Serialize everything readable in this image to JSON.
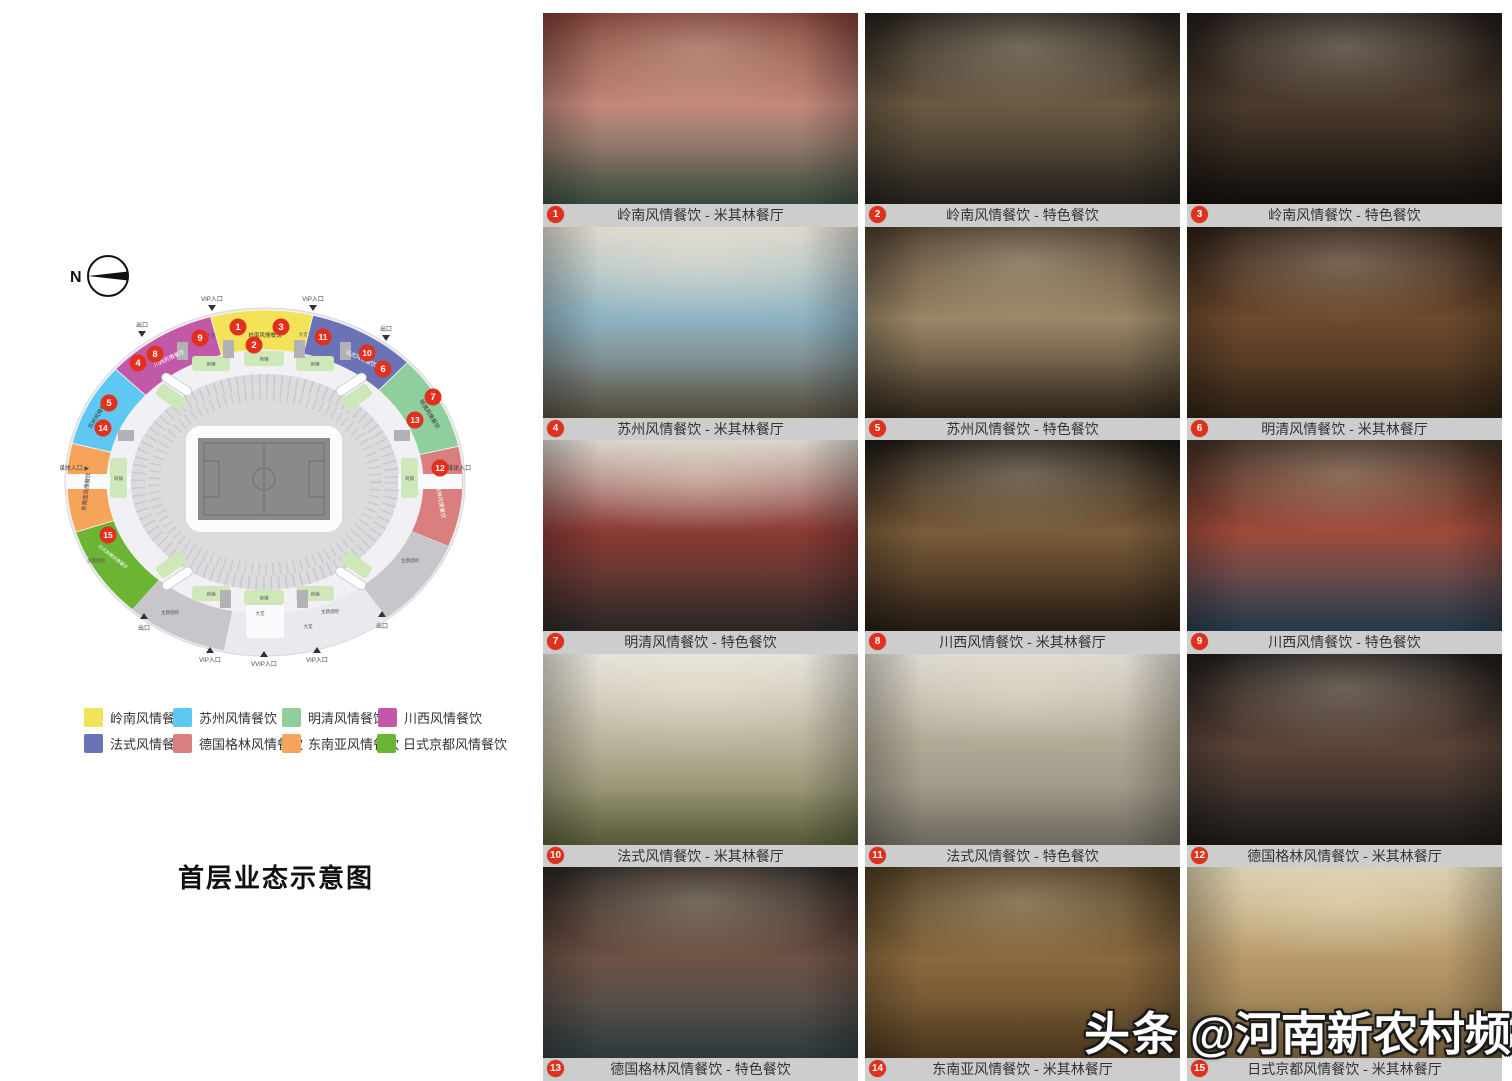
{
  "title": "首层业态示意图",
  "compass": {
    "north_label": "N"
  },
  "legend": {
    "items": [
      {
        "label": "岭南风情餐饮",
        "color": "#f2e359"
      },
      {
        "label": "苏州风情餐饮",
        "color": "#5ec8f2"
      },
      {
        "label": "明清风情餐饮",
        "color": "#8fce9d"
      },
      {
        "label": "川西风情餐饮",
        "color": "#c159a8"
      },
      {
        "label": "法式风情餐饮",
        "color": "#6a73b5"
      },
      {
        "label": "德国格林风情餐饮",
        "color": "#d97f7f"
      },
      {
        "label": "东南亚风情餐饮",
        "color": "#f6a45a"
      },
      {
        "label": "日式京都风情餐饮",
        "color": "#6cb434"
      }
    ]
  },
  "stadium": {
    "labels": {
      "vip_entrance": "VIP入口",
      "vvip_entrance": "VVIP入口",
      "exit": "出口",
      "media_entrance_left": "媒体入口 ▶",
      "media_entrance_right": "◀ 媒体入口",
      "lobby": "大堂",
      "theme_bar": "主题酒吧",
      "shop": "商铺"
    },
    "markers": [
      {
        "num": "1"
      },
      {
        "num": "2"
      },
      {
        "num": "3"
      },
      {
        "num": "4"
      },
      {
        "num": "5"
      },
      {
        "num": "6"
      },
      {
        "num": "7"
      },
      {
        "num": "8"
      },
      {
        "num": "9"
      },
      {
        "num": "10"
      },
      {
        "num": "11"
      },
      {
        "num": "12"
      },
      {
        "num": "13"
      },
      {
        "num": "14"
      },
      {
        "num": "15"
      }
    ]
  },
  "photos": [
    {
      "num": "1",
      "caption": "岭南风情餐饮 - 米其林餐厅",
      "palette": [
        "#7a3d33",
        "#c4897c",
        "#49604e"
      ]
    },
    {
      "num": "2",
      "caption": "岭南风情餐饮 - 特色餐饮",
      "palette": [
        "#241f1a",
        "#6b5a42",
        "#2e2a24"
      ]
    },
    {
      "num": "3",
      "caption": "岭南风情餐饮 - 特色餐饮",
      "palette": [
        "#221c18",
        "#4a3a2c",
        "#17130f"
      ]
    },
    {
      "num": "4",
      "caption": "苏州风情餐饮 - 米其林餐厅",
      "palette": [
        "#ddd8cc",
        "#8fb4c4",
        "#6a5f4c"
      ]
    },
    {
      "num": "5",
      "caption": "苏州风情餐饮 - 特色餐饮",
      "palette": [
        "#4a3a2a",
        "#9a8868",
        "#3a2e20"
      ]
    },
    {
      "num": "6",
      "caption": "明清风情餐饮 - 米其林餐厅",
      "palette": [
        "#2a1f16",
        "#6e4a2e",
        "#3a2a1a"
      ]
    },
    {
      "num": "7",
      "caption": "明清风情餐饮 - 特色餐饮",
      "palette": [
        "#d8d4cc",
        "#8a3a34",
        "#35322e"
      ]
    },
    {
      "num": "8",
      "caption": "川西风情餐饮 - 米其林餐厅",
      "palette": [
        "#1a1714",
        "#7a5c3a",
        "#2e2318"
      ]
    },
    {
      "num": "9",
      "caption": "川西风情餐饮 - 特色餐饮",
      "palette": [
        "#3a2e22",
        "#a04a3a",
        "#2e4a5e"
      ]
    },
    {
      "num": "10",
      "caption": "法式风情餐饮 - 米其林餐厅",
      "palette": [
        "#e5e2da",
        "#b8b29a",
        "#6e7248"
      ]
    },
    {
      "num": "11",
      "caption": "法式风情餐饮 - 特色餐饮",
      "palette": [
        "#dcd8d0",
        "#b0a894",
        "#8a8578"
      ]
    },
    {
      "num": "12",
      "caption": "德国格林风情餐饮 - 米其林餐厅",
      "palette": [
        "#1e1a18",
        "#5a4438",
        "#22201e"
      ]
    },
    {
      "num": "13",
      "caption": "德国格林风情餐饮 - 特色餐饮",
      "palette": [
        "#2a2420",
        "#6e5244",
        "#3a4a4e"
      ]
    },
    {
      "num": "14",
      "caption": "东南亚风情餐饮 - 米其林餐厅",
      "palette": [
        "#4a3a22",
        "#8a6a3e",
        "#5c4426"
      ]
    },
    {
      "num": "15",
      "caption": "日式京都风情餐饮 - 米其林餐厅",
      "palette": [
        "#d8cfae",
        "#b89a6a",
        "#8a7248"
      ]
    }
  ],
  "watermark": {
    "brand": "头条",
    "handle": "@河南新农村频道"
  },
  "colors": {
    "badge_red": "#e2301c",
    "caption_bar": "#cdcdcd",
    "footprint": "#e9e9ee",
    "stands": "#dcdcdf",
    "pitch": "#8a8a8a",
    "shop_block": "#cfe8ba"
  }
}
